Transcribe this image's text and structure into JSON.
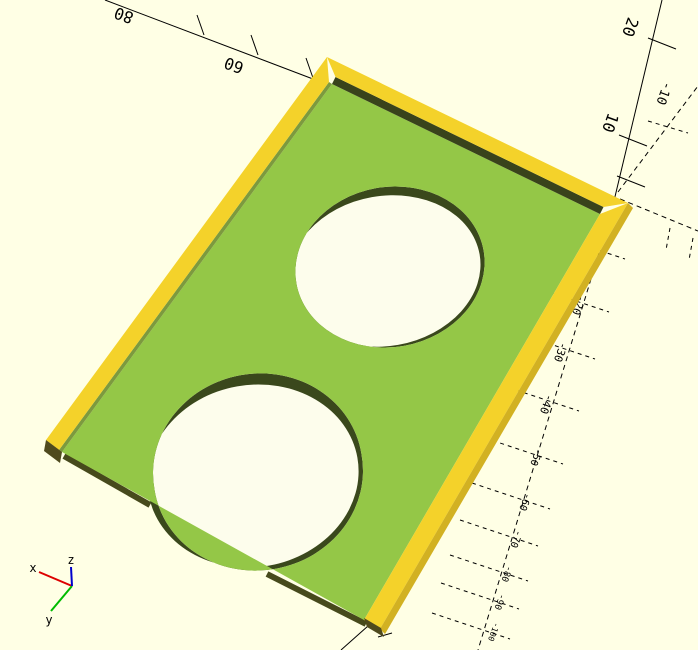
{
  "viewport": {
    "kind": "3d-preview",
    "background_color": "#FFFFE5",
    "hole_color": "#FDFDEC"
  },
  "model": {
    "floor_color": "#94C747",
    "rim_color": "#F4D22A",
    "rim_side_color": "#D2B122",
    "rim_shadow_color": "#39431B",
    "rim_inner_lit_color": "#7C9A3E",
    "edge_shadow_color": "#474A1C",
    "end_cap_color": "#4F4A1D",
    "hole_wall_color": "#3A481C"
  },
  "axes": {
    "color": "#000000",
    "x_positive": {
      "labels": [
        {
          "text": "60"
        },
        {
          "text": "80"
        }
      ]
    },
    "z_positive": {
      "labels": [
        {
          "text": "10"
        },
        {
          "text": "20"
        }
      ]
    },
    "y_negative": {
      "labels": [
        {
          "text": "-10"
        }
      ]
    },
    "z_negative": {
      "labels": [
        {
          "text": "-20"
        },
        {
          "text": "-30"
        },
        {
          "text": "-40"
        },
        {
          "text": "-50"
        },
        {
          "text": "-60"
        },
        {
          "text": "-70"
        },
        {
          "text": "-80"
        },
        {
          "text": "-90"
        },
        {
          "text": "-100"
        }
      ]
    }
  },
  "indicator": {
    "x_label": "x",
    "y_label": "y",
    "z_label": "z",
    "x_color": "#DD0000",
    "y_color": "#00BB00",
    "z_color": "#0000CC"
  }
}
